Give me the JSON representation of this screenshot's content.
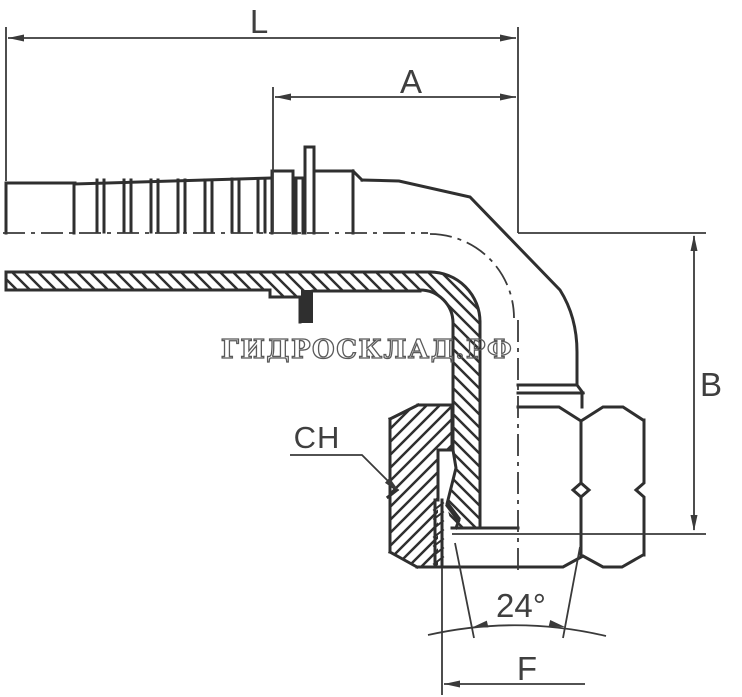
{
  "labels": {
    "L": "L",
    "A": "A",
    "B": "B",
    "CH": "CH",
    "F": "F",
    "angle": "24°"
  },
  "watermark": {
    "text": "ГИДРОСКЛАД.РФ",
    "color": "#5a5a5a"
  },
  "colors": {
    "background": "#ffffff",
    "outline": "#2f2f2f",
    "dimension": "#3a3a3a",
    "label": "#3f3f3f"
  }
}
